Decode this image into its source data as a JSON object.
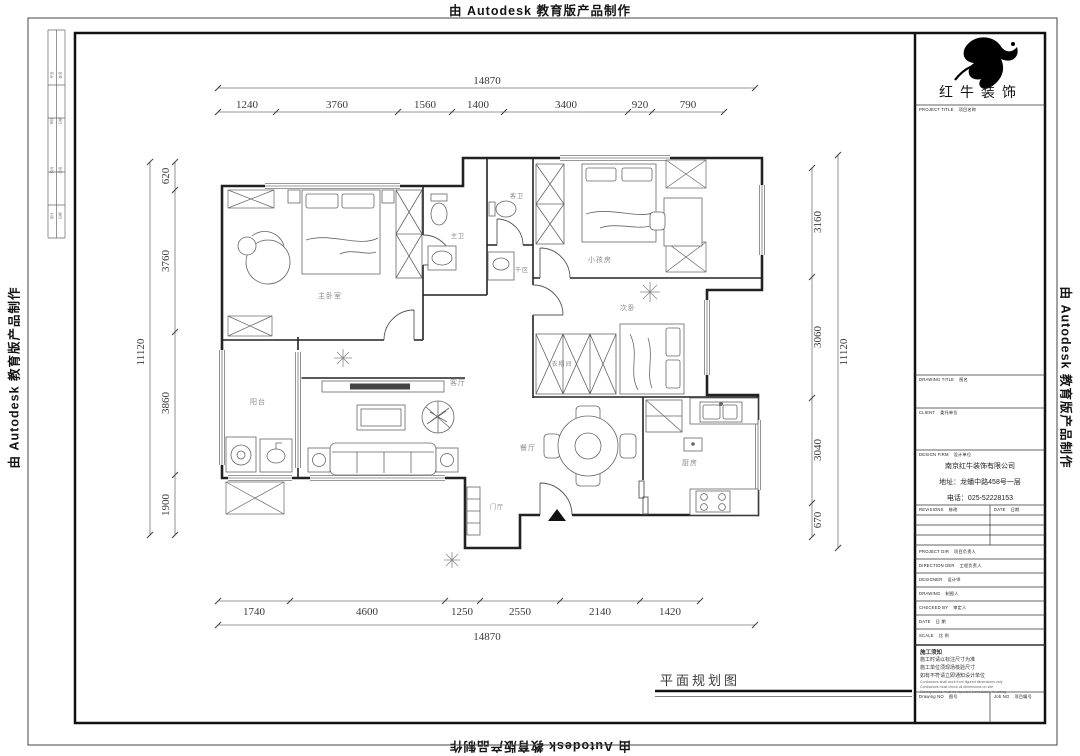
{
  "banner": {
    "text": "由 Autodesk 教育版产品制作"
  },
  "sheet": {
    "drawing_tab_label": "平面规划图"
  },
  "sign_strip": {
    "rows": [
      {
        "a": "专业",
        "b": "姓名"
      },
      {
        "a": "审核",
        "b": "日期"
      },
      {
        "a": "校对",
        "b": "签名"
      },
      {
        "a": "设计",
        "b": "日期"
      }
    ]
  },
  "title_block": {
    "logo_text": "红牛装饰",
    "sections": {
      "project_title_en": "PROJECT TITLE",
      "project_title_cn": "项目名称",
      "drawing_title_en": "DRAWING TITLE",
      "drawing_title_cn": "图名",
      "client_en": "CLIENT",
      "client_cn": "委托单位",
      "design_firm_en": "DESIGN FIRM",
      "design_firm_cn": "设计单位",
      "revisions_en": "REVISIONS",
      "revisions_cn": "修改",
      "date_en": "DATE",
      "date_cn": "日期"
    },
    "firm": {
      "name": "南京红牛装饰有限公司",
      "address": "地址：龙蟠中路458号一层",
      "phone": "电话：025-52228153"
    },
    "rows": [
      {
        "en": "PROJECT DIR",
        "cn": "项目负责人"
      },
      {
        "en": "DIRECTION DER",
        "cn": "工程负责人"
      },
      {
        "en": "DESIGNER",
        "cn": "设计师"
      },
      {
        "en": "DRAWING",
        "cn": "制图人"
      },
      {
        "en": "CHECKED BY",
        "cn": "审定人"
      },
      {
        "en": "DATE",
        "cn": "日 期"
      },
      {
        "en": "SCALE",
        "cn": "比 例"
      }
    ],
    "notes": {
      "title_cn": "施工须知",
      "cn": [
        "施工时请以标注尺寸为准",
        "施工单位须现场核验尺寸",
        "如有不符请立即通知设计单位"
      ],
      "en": [
        "Contractors shall work from figured dimensions only",
        "Contractors must check all dimensions on site",
        "Discrepancies must be reported immediately in writing"
      ]
    },
    "drawing_no_en": "Drawing NO",
    "drawing_no_cn": "图号",
    "job_no_en": "Job NO",
    "job_no_cn": "项目编号"
  },
  "rooms": {
    "master_bedroom": "主卧室",
    "master_bath": "主卫",
    "guest_bath": "客卫",
    "dry_area": "干区",
    "kids_room": "小孩房",
    "second_bedroom": "次卧",
    "closet": "衣帽间",
    "living_room": "客厅",
    "dining_room": "餐厅",
    "kitchen": "厨房",
    "balcony": "阳台",
    "foyer": "门厅"
  },
  "dims": {
    "top_total": "14870",
    "top": [
      "1240",
      "3760",
      "1560",
      "1400",
      "3400",
      "920",
      "790"
    ],
    "bottom": [
      "1740",
      "4600",
      "1250",
      "2550",
      "2140",
      "1420"
    ],
    "bottom_total": "14870",
    "left_total": "11120",
    "left": [
      "620",
      "3760",
      "3860",
      "1900"
    ],
    "right": [
      "3160",
      "3060",
      "3040",
      "670"
    ],
    "right_total": "11120"
  },
  "colors": {
    "wall": "#222222",
    "dim_text": "#3a3a3a",
    "room_label": "#8a8a8a",
    "accent": "#000000"
  }
}
